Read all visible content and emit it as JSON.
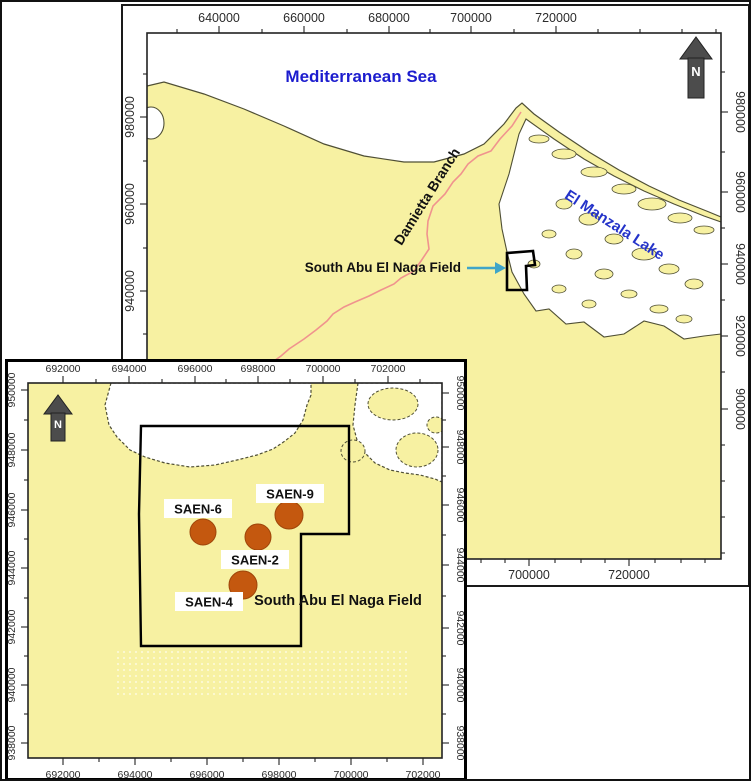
{
  "figure": {
    "type": "location-map"
  },
  "colors": {
    "land": "#F7F1A2",
    "water": "#FFFFFF",
    "coast": "#4f4f35",
    "river": "#F0938E",
    "well": "#C4580F",
    "well_stroke": "#9E4509",
    "arrow": "#3FA5C8",
    "sea_text": "#1C1CCE",
    "lake_text": "#2433C9",
    "north": "#4C4C4C",
    "boundary": "#000000"
  },
  "main_map": {
    "sea_label": "Mediterranean Sea",
    "river_label": "Damietta Branch",
    "lake_label": "El Manzala Lake",
    "field_label": "South Abu El Naga Field",
    "north_label": "N",
    "axis": {
      "top": [
        "640000",
        "660000",
        "680000",
        "700000",
        "720000"
      ],
      "bottom": [
        "700000",
        "720000"
      ],
      "left": [
        "980000",
        "960000",
        "940000"
      ],
      "right": [
        "980000",
        "960000",
        "940000",
        "920000",
        "900000"
      ]
    }
  },
  "inset_map": {
    "north_label": "N",
    "field_label": "South Abu El Naga Field",
    "axis": {
      "top": [
        "692000",
        "694000",
        "696000",
        "698000",
        "700000",
        "702000"
      ],
      "bottom": [
        "692000",
        "694000",
        "696000",
        "698000",
        "700000",
        "702000"
      ],
      "left": [
        "950000",
        "948000",
        "946000",
        "944000",
        "942000",
        "940000",
        "938000"
      ],
      "right": [
        "950000",
        "948000",
        "946000",
        "944000",
        "942000",
        "940000",
        "938000"
      ]
    },
    "wells": [
      {
        "name": "SAEN-6",
        "x": 195,
        "y": 170,
        "r": 13,
        "label_x": 190,
        "label_y": 147
      },
      {
        "name": "SAEN-9",
        "x": 281,
        "y": 153,
        "r": 14,
        "label_x": 282,
        "label_y": 132
      },
      {
        "name": "SAEN-2",
        "x": 250,
        "y": 175,
        "r": 13,
        "label_x": 247,
        "label_y": 198
      },
      {
        "name": "SAEN-4",
        "x": 235,
        "y": 223,
        "r": 14,
        "label_x": 201,
        "label_y": 240
      }
    ]
  }
}
